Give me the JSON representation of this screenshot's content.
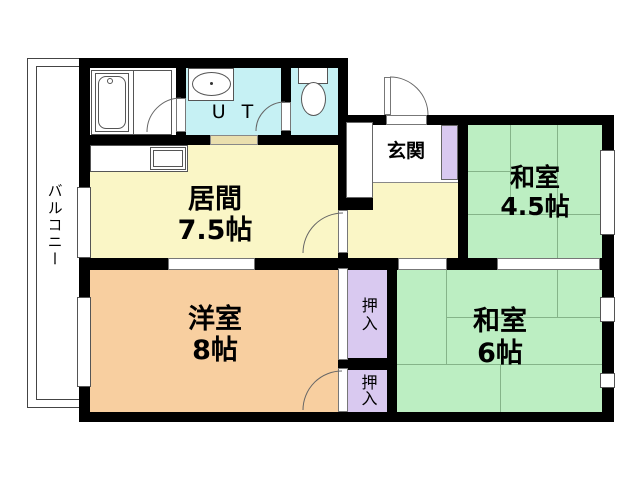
{
  "rooms": {
    "balcony": {
      "name": "バルコニー"
    },
    "living": {
      "name": "居間",
      "size": "7.5帖"
    },
    "western": {
      "name": "洋室",
      "size": "8帖"
    },
    "tatami_small": {
      "name": "和室",
      "size": "4.5帖"
    },
    "tatami_large": {
      "name": "和室",
      "size": "6帖"
    },
    "entrance": {
      "name": "玄関"
    },
    "utility": {
      "name": "U T"
    },
    "closet_upper": {
      "name": "押入"
    },
    "closet_lower": {
      "name": "押入"
    }
  },
  "colors": {
    "wall": "#000000",
    "living_floor": "#faf6c6",
    "western_floor": "#f8cfa0",
    "tatami_floor": "#bceec2",
    "wet_floor": "#c6f1f4",
    "closet_floor": "#d9c9f0",
    "step": "#eadfae",
    "tatami_line": "#85b489",
    "outline": "#555555"
  }
}
